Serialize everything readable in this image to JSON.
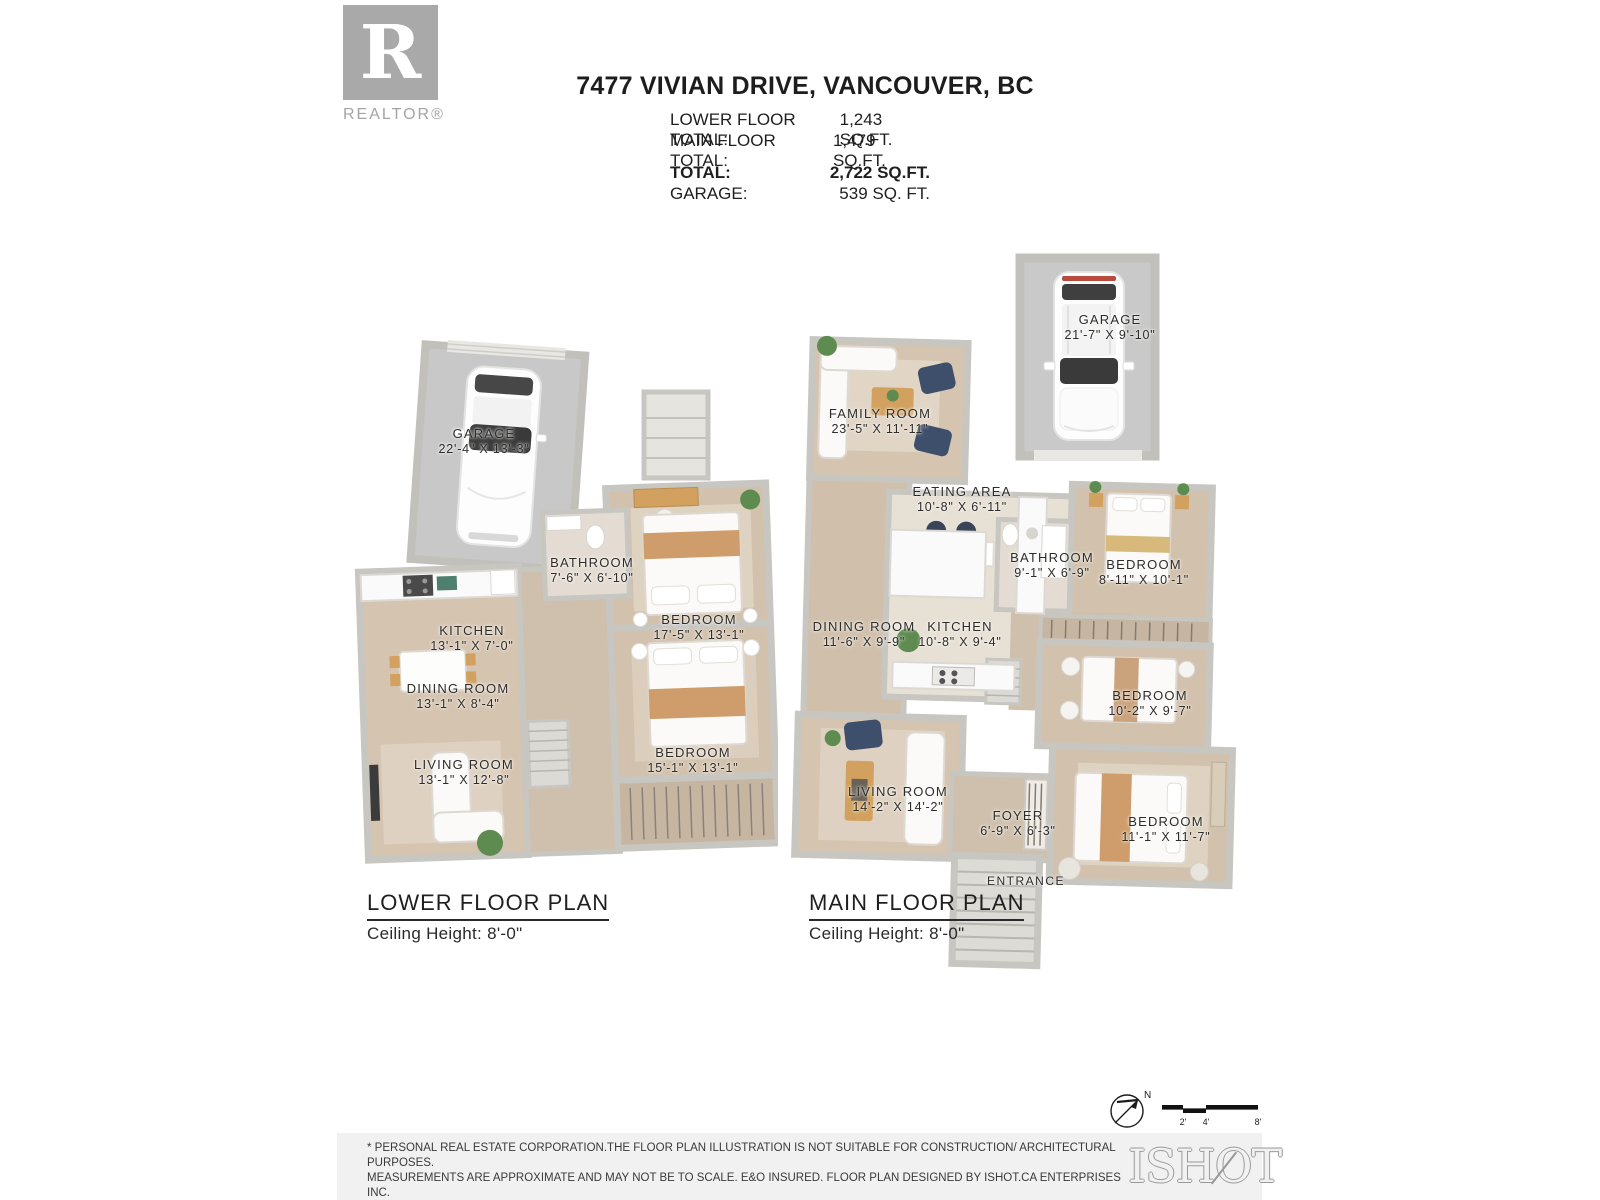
{
  "header": {
    "logo_r": "R",
    "logo_label": "REALTOR®",
    "address": "7477 VIVIAN DRIVE, VANCOUVER, BC",
    "totals": [
      {
        "label": "LOWER FLOOR TOTAL:",
        "value": "1,243 SQ.FT."
      },
      {
        "label": "MAIN FLOOR TOTAL:",
        "value": "1,479 SQ.FT."
      },
      {
        "label": "TOTAL:",
        "value": "2,722 SQ.FT."
      },
      {
        "label": "GARAGE:",
        "value": "539 SQ. FT."
      }
    ]
  },
  "lower_floor": {
    "title": "LOWER FLOOR PLAN",
    "ceiling": "Ceiling Height: 8'-0\"",
    "rooms": [
      {
        "name": "GARAGE",
        "dims": "22'-4\" X 13'-3\""
      },
      {
        "name": "BATHROOM",
        "dims": "7'-6\" X 6'-10\""
      },
      {
        "name": "KITCHEN",
        "dims": "13'-1\" X 7'-0\""
      },
      {
        "name": "DINING ROOM",
        "dims": "13'-1\" X 8'-4\""
      },
      {
        "name": "LIVING ROOM",
        "dims": "13'-1\" X 12'-8\""
      },
      {
        "name": "BEDROOM",
        "dims": "17'-5\" X 13'-1\""
      },
      {
        "name": "BEDROOM",
        "dims": "15'-1\" X 13'-1\""
      }
    ]
  },
  "main_floor": {
    "title": "MAIN FLOOR PLAN",
    "ceiling": "Ceiling Height: 8'-0\"",
    "garage": {
      "name": "GARAGE",
      "dims": "21'-7\" X 9'-10\""
    },
    "rooms": [
      {
        "name": "FAMILY ROOM",
        "dims": "23'-5\" X 11'-11\""
      },
      {
        "name": "EATING AREA",
        "dims": "10'-8\" X 6'-11\""
      },
      {
        "name": "BATHROOM",
        "dims": "9'-1\" X 6'-9\""
      },
      {
        "name": "BEDROOM",
        "dims": "8'-11\" X 10'-1\""
      },
      {
        "name": "DINING ROOM",
        "dims": "11'-6\" X 9'-9\""
      },
      {
        "name": "KITCHEN",
        "dims": "10'-8\" X 9'-4\""
      },
      {
        "name": "BEDROOM",
        "dims": "10'-2\" X 9'-7\""
      },
      {
        "name": "LIVING ROOM",
        "dims": "14'-2\" X 14'-2\""
      },
      {
        "name": "FOYER",
        "dims": "6'-9\" X 6'-3\""
      },
      {
        "name": "BEDROOM",
        "dims": "11'-1\" X 11'-7\""
      },
      {
        "name": "ENTRANCE",
        "dims": ""
      }
    ]
  },
  "scalebar": {
    "north": "N",
    "ticks": [
      "2'",
      "4'",
      "8'"
    ]
  },
  "footer": {
    "line1": "* PERSONAL REAL ESTATE CORPORATION.THE FLOOR PLAN ILLUSTRATION IS NOT SUITABLE FOR CONSTRUCTION/ ARCHITECTURAL PURPOSES.",
    "line2": "MEASUREMENTS ARE APPROXIMATE AND MAY NOT BE TO SCALE. E&O INSURED. FLOOR PLAN DESIGNED BY ISHOT.CA ENTERPRISES INC.",
    "line3": "604-368-7979  ISHOT.CA",
    "brand": "ISHOT"
  },
  "colors": {
    "wood_floor": "#d3c2ae",
    "bedroom_floor": "#d2c1ac",
    "garage_floor": "#c9c9c9",
    "wall": "#c8c6c1",
    "accent_tan": "#d2a15f",
    "blanket_tan": "#cf9d6b",
    "navy_chair": "#3d4f6b",
    "plant_green": "#5e8b4f",
    "footer_band": "#f1f1f1",
    "logo_gray": "#a9a9a9"
  }
}
